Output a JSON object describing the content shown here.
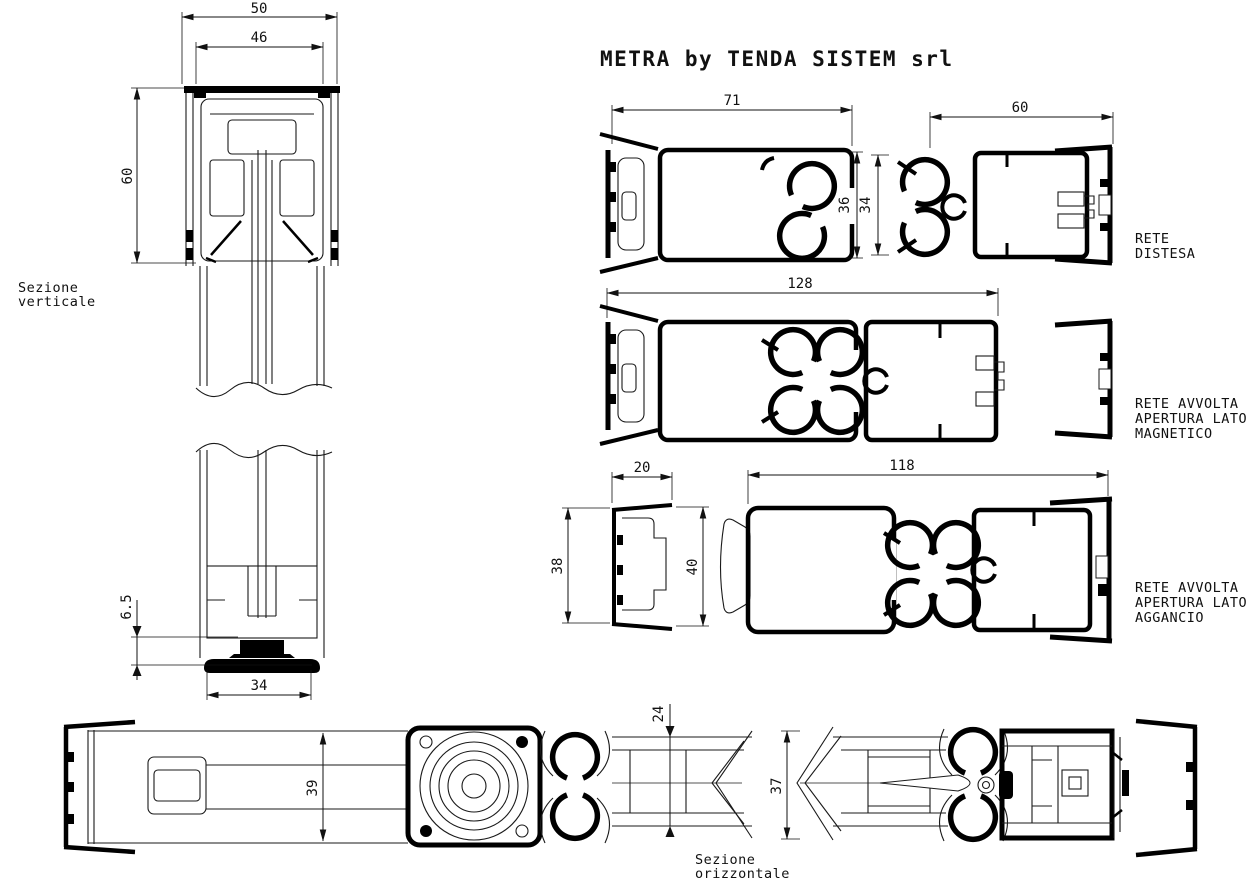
{
  "page": {
    "background": "#ffffff",
    "line_color": "#000000"
  },
  "title": "METRA by TENDA SISTEM srl",
  "sections": {
    "vertical": {
      "label_lines": [
        "Sezione",
        "verticale"
      ],
      "dims": {
        "outer_width": "50",
        "inner_width": "46",
        "head_height": "60",
        "brush_height": "6.5",
        "bottom_width": "34"
      }
    },
    "net_extended": {
      "label_lines": [
        "RETE",
        "DISTESA"
      ],
      "dims": {
        "cassette_width": "71",
        "cassette_height": "36",
        "bar_height": "34",
        "bar_width": "60"
      }
    },
    "net_rolled_magnetic": {
      "label_lines": [
        "RETE AVVOLTA",
        "APERTURA LATO",
        "MAGNETICO"
      ],
      "dims": {
        "total_width": "128"
      }
    },
    "net_rolled_hook": {
      "label_lines": [
        "RETE AVVOLTA",
        "APERTURA LATO",
        "AGGANCIO"
      ],
      "dims": {
        "guide_width": "20",
        "guide_height_left": "38",
        "guide_height_right": "40",
        "total_width": "118"
      }
    },
    "horizontal": {
      "label_lines": [
        "Sezione",
        "orizzontale"
      ],
      "dims": {
        "rail_height": "39",
        "net_channel": "24",
        "handle_height": "37"
      }
    }
  }
}
